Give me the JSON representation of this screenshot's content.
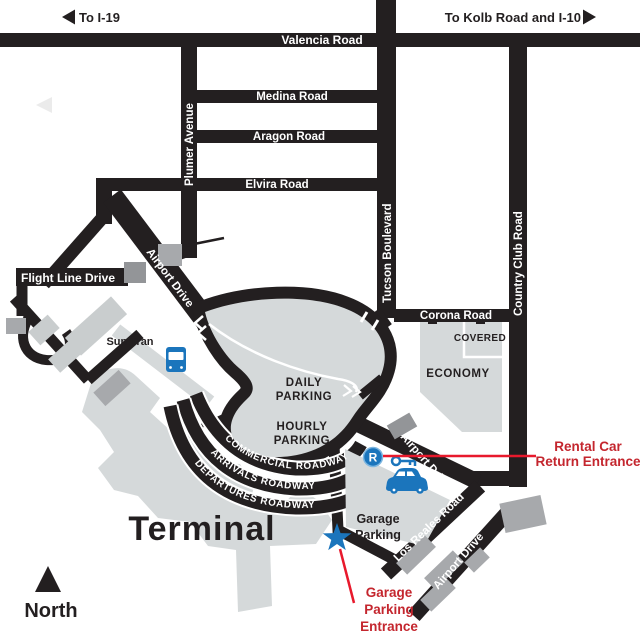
{
  "map": {
    "directions": {
      "west": "To I-19",
      "east": "To Kolb Road and I-10"
    },
    "roads": {
      "valencia": "Valencia Road",
      "medina": "Medina Road",
      "aragon": "Aragon Road",
      "elvira": "Elvira Road",
      "plumer": "Plumer Avenue",
      "tucson": "Tucson Boulevard",
      "country_club": "Country Club Road",
      "corona": "Corona Road",
      "hangar_way": "Hangar Way",
      "flight_line": "Flight Line Drive",
      "airport_drive_upper": "Airport Drive",
      "airport_drive_mid": "Airport Drive",
      "airport_drive_lower": "Airport Drive",
      "los_reales": "Los Reales Road",
      "commercial_roadway": "COMMERCIAL ROADWAY",
      "arrivals_roadway": "ARRIVALS ROADWAY",
      "departures_roadway": "DEPARTURES ROADWAY"
    },
    "areas": {
      "daily": [
        "DAILY",
        "PARKING"
      ],
      "hourly": [
        "HOURLY",
        "PARKING"
      ],
      "economy": "ECONOMY",
      "covered": "COVERED",
      "garage": [
        "Garage",
        "Parking"
      ],
      "terminal": "Terminal"
    },
    "transit": {
      "sun_tran": "Sun Tran"
    },
    "annotations": {
      "rental": [
        "Rental Car",
        "Return Entrance"
      ],
      "garage_entrance": [
        "Garage",
        "Parking",
        "Entrance"
      ]
    },
    "compass": {
      "north": "North"
    },
    "badges": {
      "rental_r": "R"
    },
    "icons": [
      "west-arrow-icon",
      "east-arrow-icon",
      "bus-icon",
      "car-key-icon",
      "rental-return-badge",
      "entrance-star-icon",
      "north-arrow-icon"
    ],
    "colors": {
      "road": "#231f20",
      "parking_lot": "#d5d9da",
      "building": "#a7a9ac",
      "building_dark": "#939598",
      "accent_blue": "#1b75bc",
      "annotation_line_red": "#e8192c",
      "annotation_text_red": "#c4262e",
      "label_white": "#ffffff"
    }
  }
}
